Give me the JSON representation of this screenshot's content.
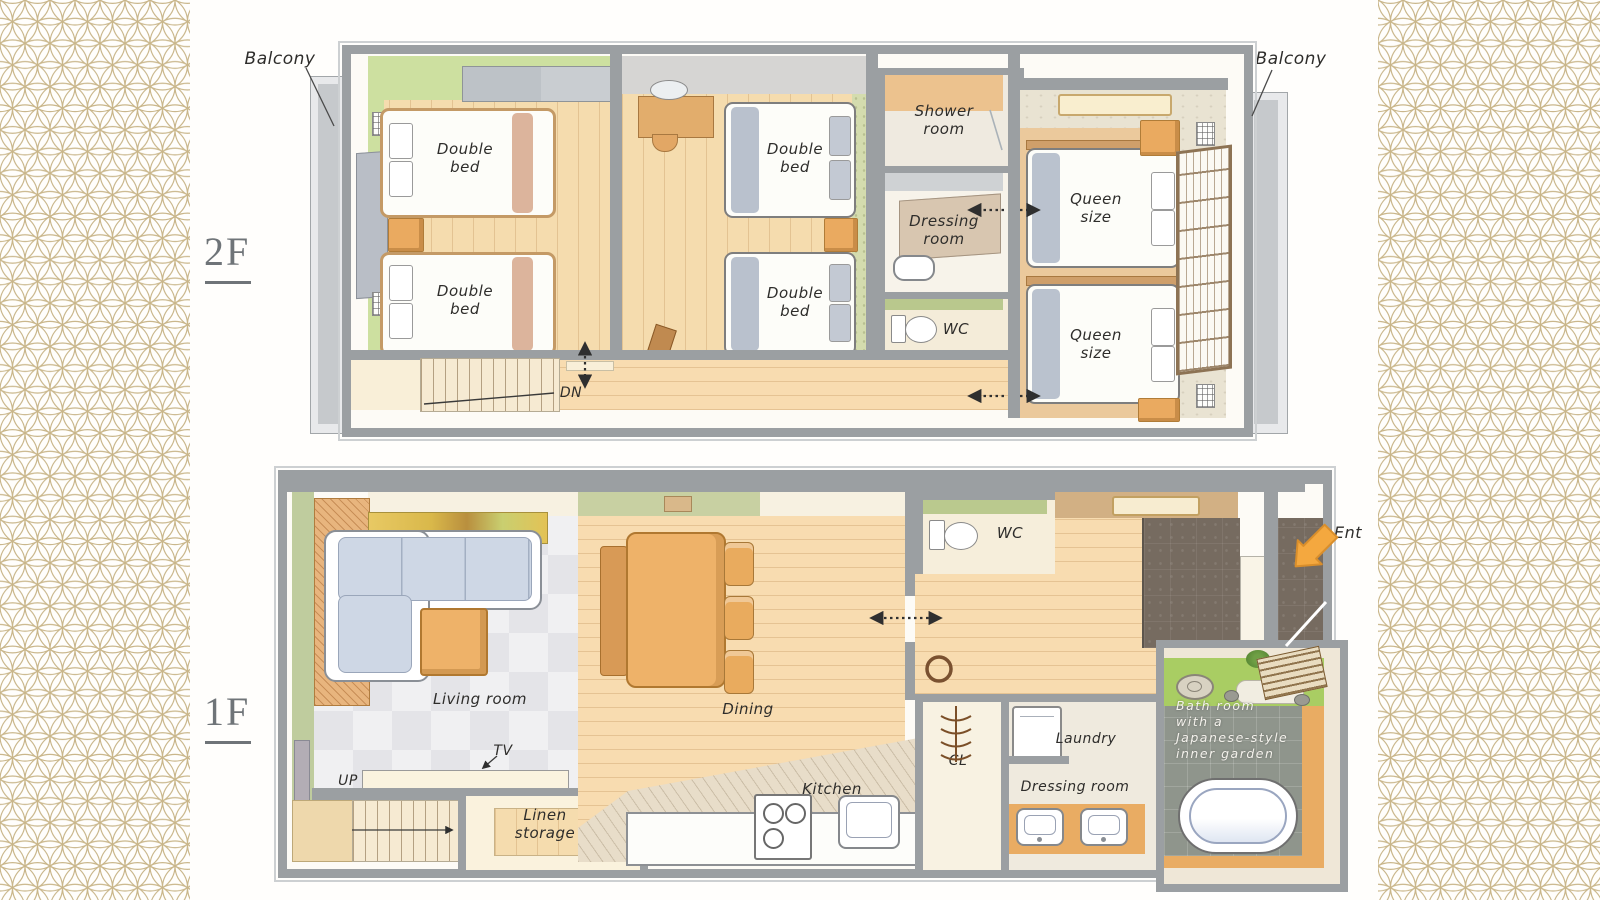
{
  "palette": {
    "pattern_gold": "#c9b68a",
    "wall_gray": "#9b9fa2",
    "wood_floor": "#f5dcae",
    "corridor_cream": "#f9efd8",
    "tatami_green": "#cde0a0",
    "furniture_orange": "#eaaa60",
    "sofa_gray": "#ced7e5",
    "queen_floor": "#ebc99c",
    "entry_arrow_orange": "#f4a83f",
    "bath_tile": "#8f958c",
    "garden_green": "#a9cd63",
    "label_ink": "#2e2d2b"
  },
  "f2": {
    "label": "2F",
    "balcony_left": "Balcony",
    "balcony_right": "Balcony",
    "double_l1": "Double",
    "double_l2": "bed",
    "queen_l1": "Queen",
    "queen_l2": "size",
    "shower_l1": "Shower",
    "shower_l2": "room",
    "dressing_l1": "Dressing",
    "dressing_l2": "room",
    "wc": "WC",
    "dn": "DN"
  },
  "f1": {
    "label": "1F",
    "living": "Living room",
    "tv": "TV",
    "up": "UP",
    "linen_l1": "Linen",
    "linen_l2": "storage",
    "dining": "Dining",
    "kitchen": "Kitchen",
    "wc": "WC",
    "cl": "CL",
    "laundry": "Laundry",
    "dressing": "Dressing room",
    "bath_l1": "Bath room",
    "bath_l2": "with a",
    "bath_l3": "Japanese-style",
    "bath_l4": "inner garden",
    "ent": "Ent"
  }
}
